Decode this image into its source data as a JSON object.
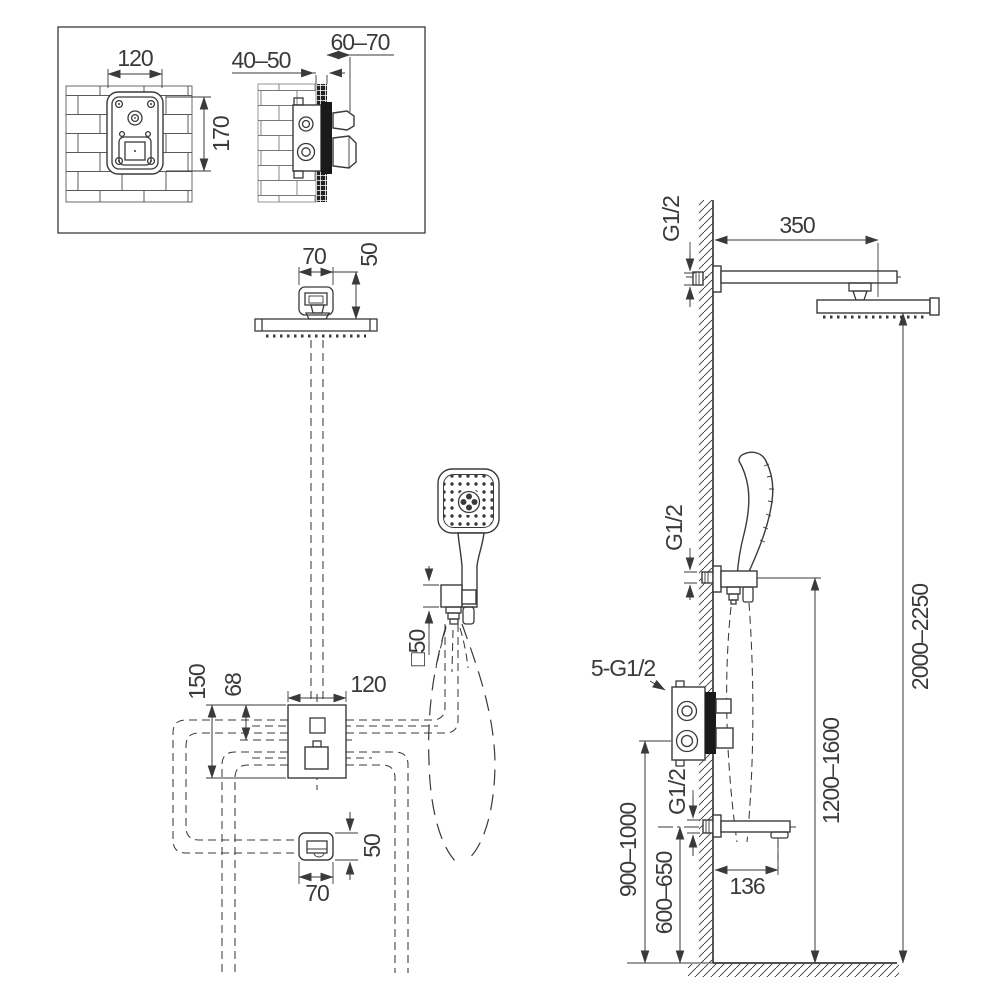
{
  "meta": {
    "drawing_type": "shower system installation dimensions",
    "views": [
      "wall box detail",
      "front view",
      "side view"
    ]
  },
  "colors": {
    "background": "#ffffff",
    "line": "#3a3a3a",
    "dark_fill": "#1a1a1a",
    "gray_fill": "#a9a9a9"
  },
  "inset": {
    "box_width": "120",
    "box_height": "170",
    "depth_rough": "40–50",
    "depth_finish": "60–70"
  },
  "front": {
    "arm_plate_width": "70",
    "arm_drop": "50",
    "valve_plate_height": "150",
    "valve_outlet_offset": "68",
    "valve_plate_width": "120",
    "bracket_square": "□50",
    "spout_height": "50",
    "spout_width": "70"
  },
  "side": {
    "thread_arm": "G1/2",
    "arm_length": "350",
    "thread_bracket": "G1/2",
    "thread_valve": "5-G1/2",
    "thread_spout": "G1/2",
    "spout_reach": "136",
    "height_valve": "900–1000",
    "height_spout": "600–650",
    "height_bracket": "1200–1600",
    "height_head": "2000–2250"
  }
}
